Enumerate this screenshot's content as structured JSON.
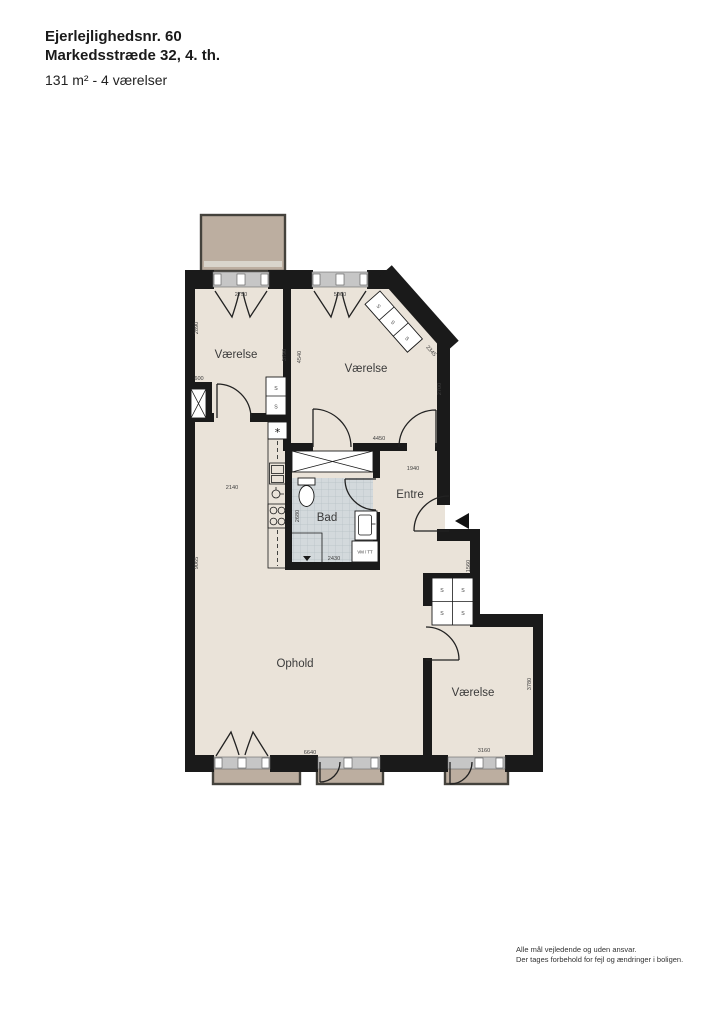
{
  "header": {
    "title_line1": "Ejerlejlighedsnr. 60",
    "title_line2": "Markedsstræde 32, 4. th.",
    "subtitle": "131 m² - 4 værelser"
  },
  "plan": {
    "rooms": {
      "vaerelse_nw": "Værelse",
      "vaerelse_ne": "Værelse",
      "entre": "Entre",
      "bad": "Bad",
      "ophold": "Ophold",
      "vaerelse_se": "Værelse"
    },
    "dims": {
      "window_nw": "2750",
      "window_ne": "5000",
      "nw_left": "2890",
      "nw_right": "3790",
      "ne_left": "4540",
      "ne_diagonal": "2345",
      "ne_right": "2700",
      "elevator_width": "600",
      "ne_bottom": "4450",
      "entre_width": "1940",
      "kitchen_width": "2140",
      "bad_left": "2680",
      "bad_bottom": "2430",
      "left_wall": "9065",
      "closet_niche": "1560",
      "se_right": "3780",
      "ophold_bottom": "6640",
      "se_bottom": "3160"
    },
    "labels": {
      "closet": "S",
      "washer_dryer": "VM / TT",
      "kitchen_symbol": "*"
    },
    "colors": {
      "wall": "#1a1a1a",
      "floor": "#EAE3D9",
      "balcony": "#BCAEA0",
      "bath_tile": "#D3D9DC",
      "window_band": "#C6C6C6"
    }
  },
  "footer": {
    "line1": "Alle mål vejledende og uden ansvar.",
    "line2": "Der tages forbehold for fejl og ændringer i boligen."
  }
}
